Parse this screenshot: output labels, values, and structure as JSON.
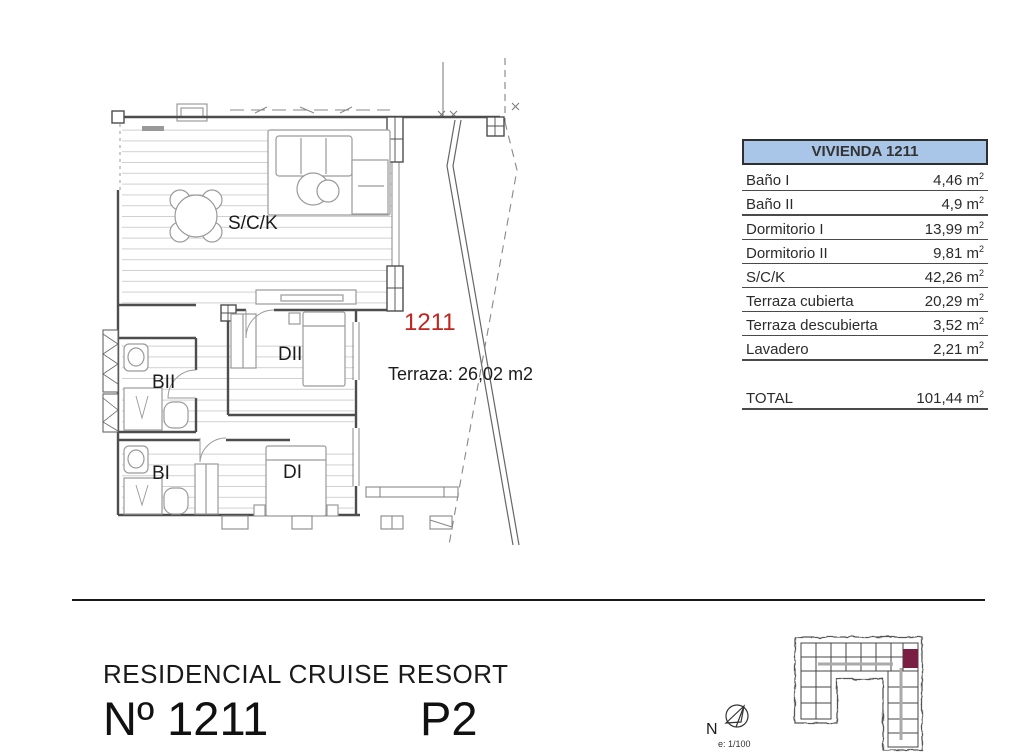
{
  "plan": {
    "labels": {
      "living": "S/C/K",
      "bedroom2": "DII",
      "bath2": "BII",
      "bath1": "BI",
      "bedroom1": "DI"
    },
    "unit_number": "1211",
    "terrace_note": "Terraza: 26,02 m2"
  },
  "area_table": {
    "title": "VIVIENDA 1211",
    "unit_base": "m",
    "unit_exp": "2",
    "rows": [
      {
        "label": "Baño I",
        "value": "4,46"
      },
      {
        "label": "Baño II",
        "value": "4,9"
      },
      {
        "label": "Dormitorio I",
        "value": "13,99"
      },
      {
        "label": "Dormitorio II",
        "value": "9,81"
      },
      {
        "label": "S/C/K",
        "value": "42,26"
      },
      {
        "label": "Terraza cubierta",
        "value": "20,29"
      },
      {
        "label": "Terraza descubierta",
        "value": "3,52"
      },
      {
        "label": "Lavadero",
        "value": "2,21"
      }
    ],
    "total": {
      "label": "TOTAL",
      "value": "101,44"
    }
  },
  "title_block": {
    "project": "RESIDENCIAL CRUISE RESORT",
    "unit": "Nº 1211",
    "floor": "P2"
  },
  "key_plan": {
    "north_label": "N",
    "scale_label": "e: 1/100"
  },
  "colors": {
    "unit_number_red": "#c0251f",
    "table_header_blue": "#a9c5e8",
    "highlight_maroon": "#7b1e44"
  }
}
